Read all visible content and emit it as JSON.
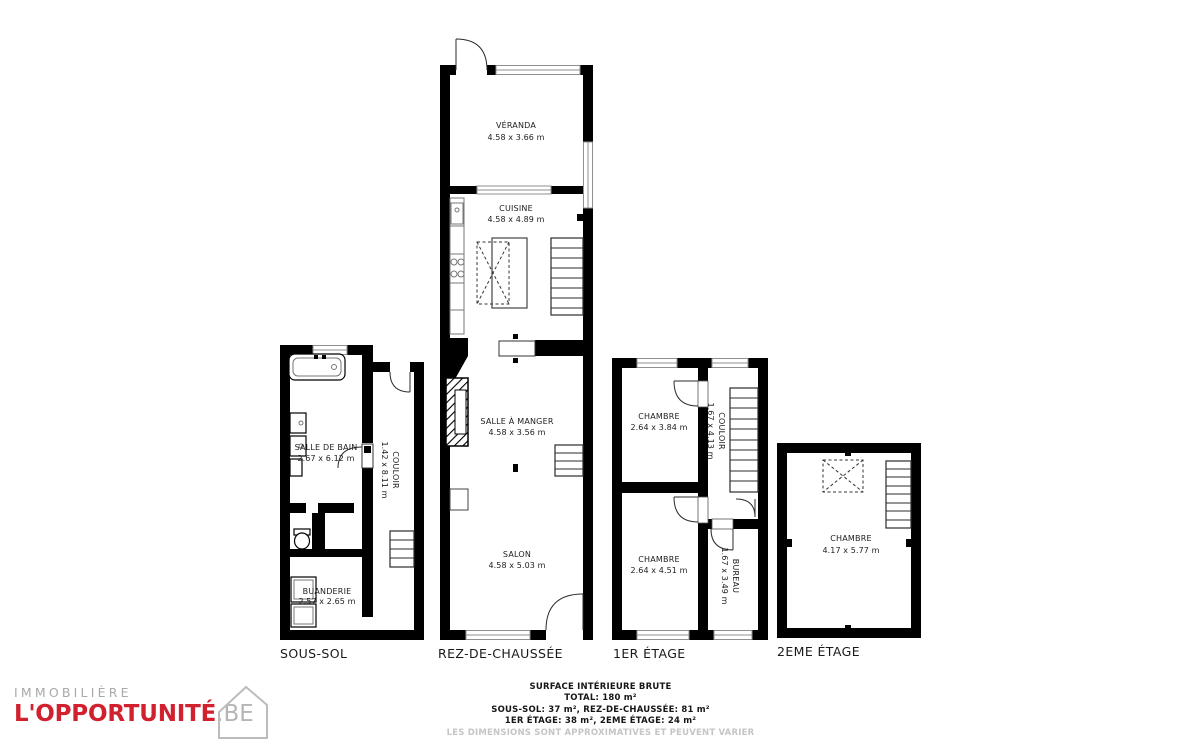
{
  "colors": {
    "wall": "#000000",
    "brand_red": "#d2212e",
    "logo_gray": "#a9a9a9",
    "disclaimer_gray": "#c5c5c5"
  },
  "logo": {
    "line1": "IMMOBILIÈRE",
    "brand": "L'OPPORTUNITÉ",
    "tld": ".BE"
  },
  "summary": {
    "title": "SURFACE INTÉRIEURE BRUTE",
    "total": "TOTAL: 180 m²",
    "line1": "SOUS-SOL: 37 m², REZ-DE-CHAUSSÉE: 81 m²",
    "line2": "1ER ÉTAGE: 38 m², 2EME ÉTAGE: 24 m²",
    "disclaimer": "LES DIMENSIONS SONT APPROXIMATIVES ET PEUVENT VARIER"
  },
  "floors": {
    "sous_sol": {
      "label": "SOUS-SOL",
      "rooms": {
        "salle_de_bain": {
          "name": "SALLE DE BAIN",
          "dims": "2.67 x 6.12 m"
        },
        "couloir": {
          "name": "COULOIR",
          "dims": "1.42 x 8.11 m"
        },
        "buanderie": {
          "name": "BUANDERIE",
          "dims": "2.57 x 2.65 m"
        }
      }
    },
    "rez_de_chaussee": {
      "label": "REZ-DE-CHAUSSÉE",
      "rooms": {
        "veranda": {
          "name": "VÉRANDA",
          "dims": "4.58 x 3.66 m"
        },
        "cuisine": {
          "name": "CUISINE",
          "dims": "4.58 x 4.89 m"
        },
        "salle_a_manger": {
          "name": "SALLE À MANGER",
          "dims": "4.58 x 3.56 m"
        },
        "salon": {
          "name": "SALON",
          "dims": "4.58 x 5.03 m"
        }
      }
    },
    "premier_etage": {
      "label": "1ER ÉTAGE",
      "rooms": {
        "chambre_1": {
          "name": "CHAMBRE",
          "dims": "2.64 x 3.84 m"
        },
        "couloir": {
          "name": "COULOIR",
          "dims": "1.67 x 4.13 m"
        },
        "chambre_2": {
          "name": "CHAMBRE",
          "dims": "2.64 x 4.51 m"
        },
        "bureau": {
          "name": "BUREAU",
          "dims": "1.67 x 3.49 m"
        }
      }
    },
    "deuxieme_etage": {
      "label": "2EME ÉTAGE",
      "rooms": {
        "chambre": {
          "name": "CHAMBRE",
          "dims": "4.17 x 5.77 m"
        }
      }
    }
  }
}
